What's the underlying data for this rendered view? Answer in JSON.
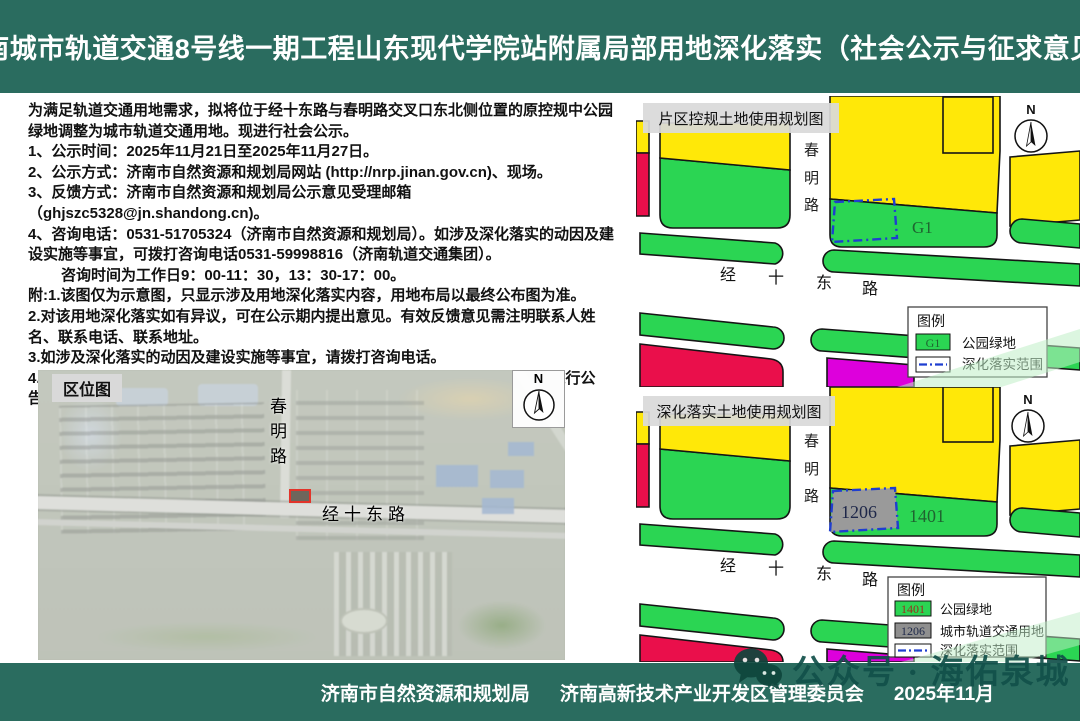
{
  "header": {
    "title": "济南城市轨道交通8号线一期工程山东现代学院站附属局部用地深化落实（社会公示与征求意见）"
  },
  "notice": {
    "paragraphs": [
      "为满足轨道交通用地需求，拟将位于经十东路与春明路交叉口东北侧位置的原控规中公园绿地调整为城市轨道交通用地。现进行社会公示。",
      "1、公示时间：2025年11月21日至2025年11月27日。",
      "2、公示方式：济南市自然资源和规划局网站 (http://nrp.jinan.gov.cn)、现场。",
      "3、反馈方式：济南市自然资源和规划局公示意见受理邮箱 （ghjszc5328@jn.shandong.cn)。",
      "4、咨询电话：0531-51705324（济南市自然资源和规划局）。如涉及深化落实的动因及建设实施等事宜，可拨打咨询电话0531-59998816（济南轨道交通集团）。",
      "咨询时间为工作日9：00-11：30，13：30-17：00。",
      "附:1.该图仅为示意图，只显示涉及用地深化落实内容，用地布局以最终公布图为准。",
      "2.对该用地深化落实如有异议，可在公示期内提出意见。有效反馈意见需注明联系人姓名、联系电话、联系地址。",
      "3.如涉及深化落实的动因及建设实施等事宜，请拨打咨询电话。",
      "4.公示意见收集、采纳情况及深化最终方案将通过济南市自然资源和规划局官网进行公告。"
    ]
  },
  "location_map": {
    "label": "区位图",
    "north_label": "N",
    "road_vertical": [
      "春",
      "明",
      "路"
    ],
    "road_horizontal": "经十东路"
  },
  "district_map": {
    "title": "片区控规土地使用规划图",
    "north_label": "N",
    "road_vertical": [
      "春",
      "明",
      "路"
    ],
    "road_horizontal": [
      "经",
      "十",
      "东",
      "路"
    ],
    "parcel_label": "G1",
    "legend": {
      "title": "图例",
      "items": [
        {
          "swatch_label": "G1",
          "label": "公园绿地"
        },
        {
          "swatch_label": "",
          "label": "深化落实范围"
        }
      ]
    }
  },
  "detail_map": {
    "title": "深化落实土地使用规划图",
    "north_label": "N",
    "road_vertical": [
      "春",
      "明",
      "路"
    ],
    "road_horizontal": [
      "经",
      "十",
      "东",
      "路"
    ],
    "parcel_labels": {
      "transit": "1206",
      "park": "1401"
    },
    "legend": {
      "title": "图例",
      "items": [
        {
          "swatch_label": "1401",
          "label": "公园绿地"
        },
        {
          "swatch_label": "1206",
          "label": "城市轨道交通用地"
        },
        {
          "swatch_label": "",
          "label": "深化落实范围"
        }
      ]
    }
  },
  "footer": {
    "agency_left": "济南市自然资源和规划局",
    "agency_right": "济南高新技术产业开发区管理委员会",
    "date": "2025年11月"
  },
  "watermark": {
    "text": "公众号 · 海佑泉城"
  },
  "colors": {
    "header_green": "#2a6c5f",
    "park_green": "#2bd553",
    "residential_yellow": "#ffe808",
    "red_parcel": "#ea0f4b",
    "magenta_parcel": "#dd00dc",
    "transit_grey": "#9a9a9a",
    "scope_dash_blue": "#1f3ed0"
  }
}
